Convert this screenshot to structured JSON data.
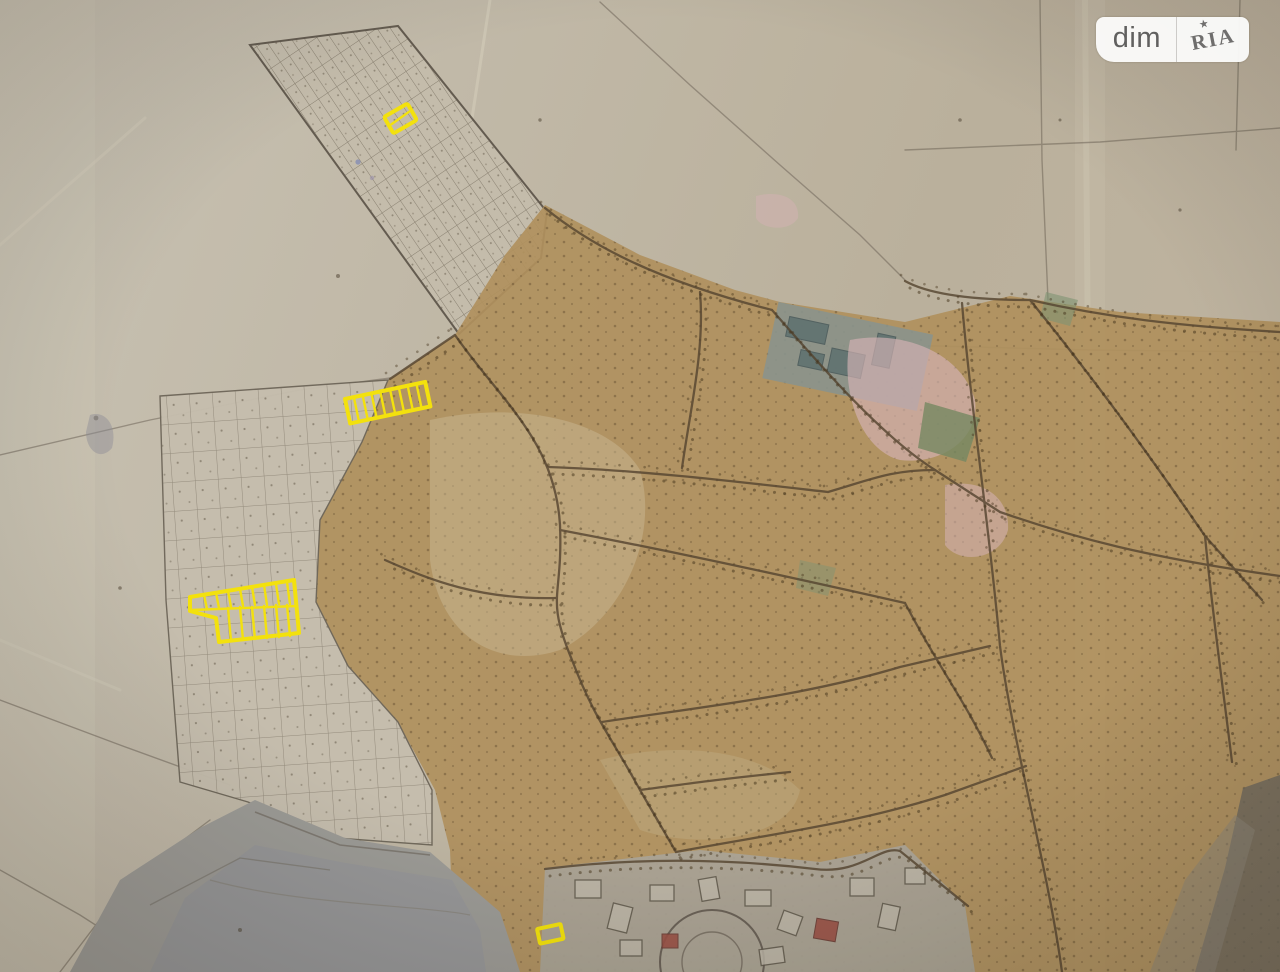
{
  "watermark": {
    "brand_left": "dim",
    "brand_right": "RIA",
    "star": "★"
  },
  "map": {
    "kind": "photographed paper master plan with highlighted land plots",
    "highlight_color": "#f7e400",
    "paper_color": "#c3baa8",
    "builtup_color": "#b2905a",
    "water_color": "#9c9a95",
    "urban_color": "#aba395",
    "highlighted_plots": [
      {
        "id": "north-allotment-plot",
        "cells": 1
      },
      {
        "id": "west-strip-of-plots",
        "cells": 9
      },
      {
        "id": "west-double-row-block",
        "cells": 16
      },
      {
        "id": "south-small-plot",
        "cells": 1
      }
    ]
  }
}
